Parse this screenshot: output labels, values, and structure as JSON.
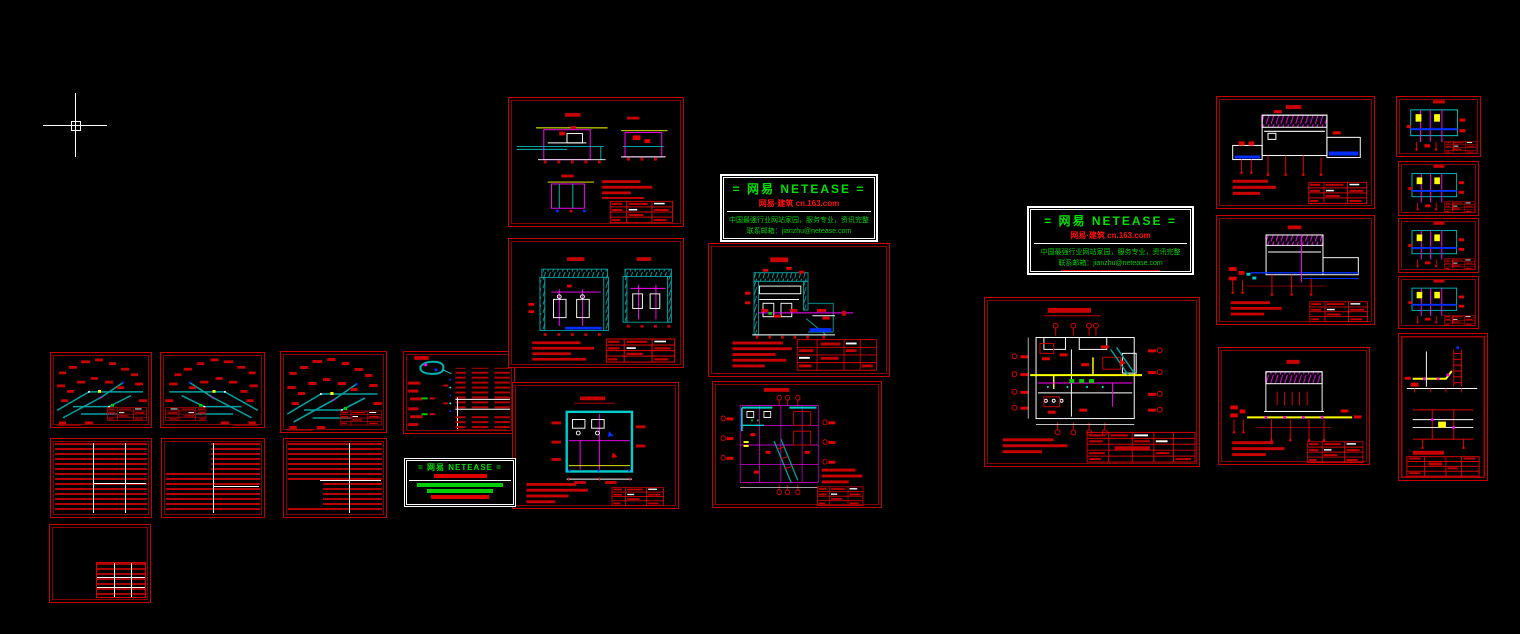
{
  "canvas": {
    "description": "CAD model space with plumbing and water-supply drawing sheets",
    "background_color": "#000000"
  },
  "cursor": {
    "type": "crosshair-with-pickbox"
  },
  "colors": {
    "sheet_border_red": "#c40000",
    "annotation_red": "#e00000",
    "pipe_teal": "#00a0a0",
    "bright_cyan": "#00ffff",
    "magenta": "#ff00ff",
    "yellow": "#ffff00",
    "green": "#00cc00",
    "water_blue": "#0030ff",
    "white": "#ffffff",
    "watermark_green": "#00e000"
  },
  "watermark_1": {
    "title": "= 网易  NETEASE =",
    "subtitle": "网易·建筑  cn.163.com",
    "line1": "中国最强行业网站家园，服务专业，资讯完整",
    "line2": "联系邮箱：jianzhu@netease.com"
  },
  "watermark_2": {
    "title": "= 网易  NETEASE =",
    "subtitle": "网易·建筑  cn.163.com",
    "line1": "中国最强行业网站家园，服务专业，资讯完整",
    "line2": "联系邮箱：jianzhu@netease.com"
  },
  "watermark_small": {
    "title": "= 网易 NETEASE ="
  }
}
